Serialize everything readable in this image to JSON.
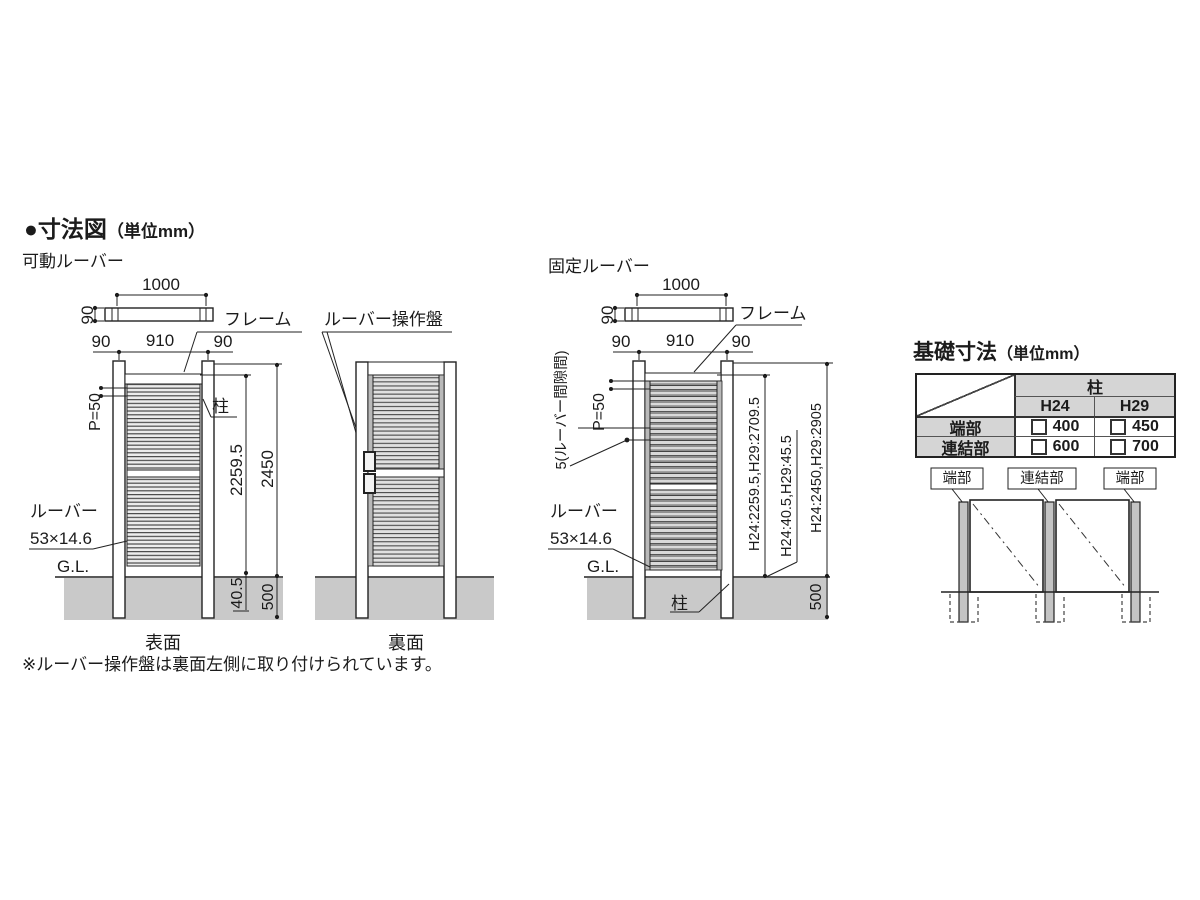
{
  "title": {
    "main": "●寸法図",
    "unit": "（単位mm）"
  },
  "note": "※ルーバー操作盤は裏面左側に取り付けられています。",
  "movable": {
    "section_label": "可動ルーバー",
    "front_caption": "表面",
    "back_caption": "裏面",
    "operator_label": "ルーバー操作盤",
    "frame_label": "フレーム",
    "post_label": "柱",
    "louver_label": "ルーバー",
    "louver_size": "53×14.6",
    "gl": "G.L.",
    "dims": {
      "top_width": "1000",
      "top_depth": "90",
      "panel_width": "910",
      "left_post": "90",
      "right_post": "90",
      "pitch": "P=50",
      "panel_height": "2259.5",
      "total_height": "2450",
      "bottom_gap": "40.5",
      "embed": "500"
    }
  },
  "fixed": {
    "section_label": "固定ルーバー",
    "frame_label": "フレーム",
    "post_label": "柱",
    "louver_label": "ルーバー",
    "louver_size": "53×14.6",
    "gap_label": "5(ルーバー間隙間)",
    "gl": "G.L.",
    "dims": {
      "top_width": "1000",
      "top_depth": "90",
      "panel_width": "910",
      "left_post": "90",
      "right_post": "90",
      "pitch": "P=50",
      "panel_height": "H24:2259.5,H29:2709.5",
      "bottom_gap": "H24:40.5,H29:45.5",
      "total_height": "H24:2450,H29:2905",
      "embed": "500"
    }
  },
  "foundation": {
    "title": "基礎寸法",
    "unit": "（単位mm）",
    "table": {
      "col_group": "柱",
      "col1": "H24",
      "col2": "H29",
      "rows": [
        {
          "label": "端部",
          "v1": "400",
          "v2": "450"
        },
        {
          "label": "連結部",
          "v1": "600",
          "v2": "700"
        }
      ]
    },
    "labels": {
      "end1": "端部",
      "joint": "連結部",
      "end2": "端部"
    }
  },
  "colors": {
    "ground": "#c9c9c9",
    "line": "#222222",
    "header_bg": "#d5d5d5",
    "post_fill": "#c4c4c4",
    "strip": "#b9b9b9"
  }
}
